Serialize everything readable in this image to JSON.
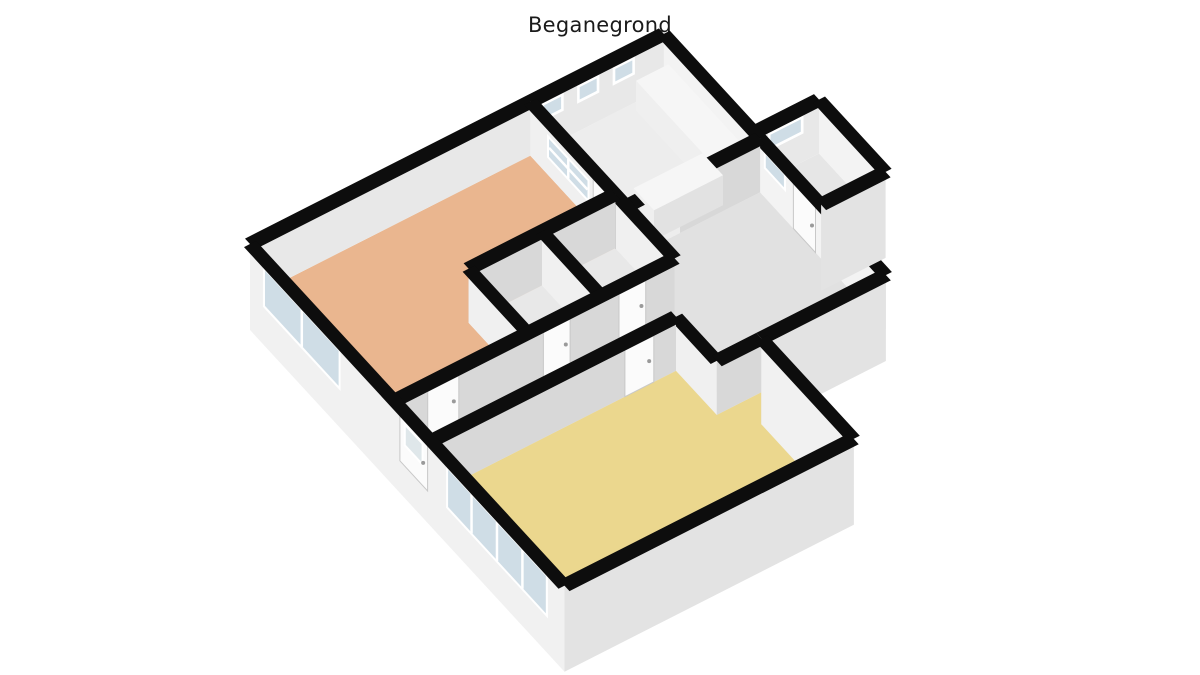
{
  "title": "Beganegrond",
  "colors": {
    "background": "#ffffff",
    "title_color": "#1a1a1a",
    "wall_top": "#0d0d0d",
    "face_a_far": "#e8e8e8",
    "face_a_int": "#d8d8d8",
    "face_a_near": "#e3e3e3",
    "face_b_far": "#f3f3f3",
    "face_b_int": "#f0f0f0",
    "face_b_near": "#f1f1f1",
    "frame": "#ffffff",
    "glass": "#cfdde6",
    "glass_frosted": "#dfe7ea",
    "door": "#fbfbfb",
    "door_edge": "#c8c8c8",
    "handle": "#9a9a9a",
    "counter_top": "#f6f6f6",
    "counter_face_a": "#e2e2e2",
    "counter_face_b": "#efefef",
    "cooktop": "#161616",
    "burner": "#c41414",
    "burner_center": "#8a0e0e",
    "radiator": "#fcfcfc",
    "floor_living": "#eab68f",
    "floor_bedroom": "#ebd78e",
    "floor_kitchen": "#ededed",
    "floor_hall": "#e1e1e1",
    "floor_small_room": "#e8e8e8",
    "floor_storage": "#e6e6e6"
  },
  "plan": {
    "origin": [
      250,
      298
    ],
    "axis_u": [
      44.5,
      -22.6
    ],
    "axis_v": [
      37.0,
      40.2
    ],
    "wall_height_px": 54,
    "plinth_px": 32,
    "wall_thickness_m": 0.27,
    "rooms": [
      {
        "name": "living-room",
        "color": "#eab68f",
        "poly": [
          [
            0,
            0
          ],
          [
            6.3,
            0
          ],
          [
            6.3,
            2.3
          ],
          [
            3.0,
            2.3
          ],
          [
            3.0,
            3.9
          ],
          [
            0,
            3.9
          ]
        ]
      },
      {
        "name": "kitchen",
        "color": "#ededed",
        "poly": [
          [
            6.3,
            0
          ],
          [
            9.3,
            0
          ],
          [
            9.3,
            2.6
          ],
          [
            6.3,
            2.6
          ]
        ]
      },
      {
        "name": "hallway",
        "color": "#e1e1e1",
        "poly": [
          [
            0,
            3.9
          ],
          [
            6.3,
            3.9
          ],
          [
            6.3,
            2.6
          ],
          [
            9.3,
            2.6
          ],
          [
            9.3,
            6.0
          ],
          [
            5.5,
            6.0
          ],
          [
            5.5,
            4.9
          ],
          [
            0,
            4.9
          ]
        ]
      },
      {
        "name": "toilet",
        "color": "#e8e8e8",
        "poly": [
          [
            3.0,
            2.3
          ],
          [
            4.65,
            2.3
          ],
          [
            4.65,
            3.9
          ],
          [
            3.0,
            3.9
          ]
        ]
      },
      {
        "name": "bathroom",
        "color": "#e8e8e8",
        "poly": [
          [
            4.65,
            2.3
          ],
          [
            6.3,
            2.3
          ],
          [
            6.3,
            3.9
          ],
          [
            4.65,
            3.9
          ]
        ]
      },
      {
        "name": "bedroom",
        "color": "#ebd78e",
        "poly": [
          [
            0,
            4.9
          ],
          [
            5.5,
            4.9
          ],
          [
            5.5,
            6.0
          ],
          [
            6.5,
            6.0
          ],
          [
            6.5,
            8.5
          ],
          [
            0,
            8.5
          ]
        ]
      },
      {
        "name": "storage",
        "color": "#e6e6e6",
        "poly": [
          [
            9.3,
            2.45
          ],
          [
            10.75,
            2.45
          ],
          [
            10.75,
            4.25
          ],
          [
            9.3,
            4.25
          ]
        ]
      }
    ],
    "walls": [
      {
        "name": "exterior-wall-nw",
        "p1": [
          0,
          0
        ],
        "p2": [
          9.3,
          0
        ],
        "kind": "far"
      },
      {
        "name": "exterior-wall-ne",
        "p1": [
          9.3,
          0
        ],
        "p2": [
          9.3,
          6.0
        ],
        "kind": "far"
      },
      {
        "name": "storage-wall-nw",
        "p1": [
          9.3,
          2.45
        ],
        "p2": [
          10.75,
          2.45
        ],
        "kind": "far"
      },
      {
        "name": "storage-wall-ne",
        "p1": [
          10.75,
          2.45
        ],
        "p2": [
          10.75,
          4.25
        ],
        "kind": "far"
      },
      {
        "name": "storage-wall-se",
        "p1": [
          9.3,
          4.25
        ],
        "p2": [
          10.75,
          4.25
        ],
        "kind": "near"
      },
      {
        "name": "wall-living-kitchen",
        "p1": [
          6.3,
          0
        ],
        "p2": [
          6.3,
          3.9
        ],
        "kind": "int"
      },
      {
        "name": "wall-kitchen-hall-a",
        "p1": [
          6.3,
          2.6
        ],
        "p2": [
          6.6,
          2.6
        ],
        "kind": "int"
      },
      {
        "name": "wall-kitchen-hall-b",
        "p1": [
          7.5,
          2.6
        ],
        "p2": [
          9.3,
          2.6
        ],
        "kind": "int"
      },
      {
        "name": "wall-smallrooms-nw",
        "p1": [
          3.0,
          2.3
        ],
        "p2": [
          6.3,
          2.3
        ],
        "kind": "int"
      },
      {
        "name": "wall-smallrooms-w",
        "p1": [
          3.0,
          2.3
        ],
        "p2": [
          3.0,
          3.9
        ],
        "kind": "int"
      },
      {
        "name": "wall-toilet-bathroom",
        "p1": [
          4.65,
          2.3
        ],
        "p2": [
          4.65,
          3.9
        ],
        "kind": "int"
      },
      {
        "name": "wall-corridor-nw",
        "p1": [
          0,
          3.9
        ],
        "p2": [
          6.3,
          3.9
        ],
        "kind": "int"
      },
      {
        "name": "wall-corridor-bedroom",
        "p1": [
          0,
          4.9
        ],
        "p2": [
          5.5,
          4.9
        ],
        "kind": "int"
      },
      {
        "name": "wall-closet-ne",
        "p1": [
          5.5,
          4.9
        ],
        "p2": [
          5.5,
          6.0
        ],
        "kind": "int"
      },
      {
        "name": "wall-closet-se",
        "p1": [
          5.5,
          6.0
        ],
        "p2": [
          6.5,
          6.0
        ],
        "kind": "int"
      },
      {
        "name": "wall-bedroom-ne",
        "p1": [
          6.5,
          6.0
        ],
        "p2": [
          6.5,
          8.5
        ],
        "kind": "near"
      },
      {
        "name": "exterior-wall-sw",
        "p1": [
          0,
          0
        ],
        "p2": [
          0,
          8.5
        ],
        "kind": "near"
      },
      {
        "name": "exterior-wall-se-bedroom",
        "p1": [
          0,
          8.5
        ],
        "p2": [
          6.5,
          8.5
        ],
        "kind": "near"
      },
      {
        "name": "exterior-wall-se-hall",
        "p1": [
          6.5,
          6.0
        ],
        "p2": [
          9.3,
          6.0
        ],
        "kind": "near"
      }
    ],
    "windows": [
      {
        "name": "kitchen-clerestory-1",
        "wall": "exterior-wall-nw",
        "from": 6.55,
        "to": 7.05,
        "y0": 0.52,
        "y1": 0.86
      },
      {
        "name": "kitchen-clerestory-2",
        "wall": "exterior-wall-nw",
        "from": 7.35,
        "to": 7.85,
        "y0": 0.52,
        "y1": 0.86
      },
      {
        "name": "kitchen-clerestory-3",
        "wall": "exterior-wall-nw",
        "from": 8.15,
        "to": 8.65,
        "y0": 0.52,
        "y1": 0.86
      },
      {
        "name": "hall-high-window",
        "wall": "exterior-wall-ne",
        "from": 2.7,
        "to": 3.3,
        "y0": 0.52,
        "y1": 0.86
      },
      {
        "name": "storage-high-window",
        "wall": "storage-wall-nw",
        "from": 0.3,
        "to": 1.1,
        "y0": 0.52,
        "y1": 0.86
      },
      {
        "name": "kitchen-hatch-window",
        "wall": "wall-living-kitchen",
        "from": 0.45,
        "to": 1.6,
        "y0": 0.3,
        "y1": 0.74,
        "mullions": 1,
        "hmullions": 1
      },
      {
        "name": "living-room-window",
        "wall": "exterior-wall-sw",
        "from": 0.35,
        "to": 2.45,
        "y0": 0.1,
        "y1": 0.86,
        "mullions": 1
      },
      {
        "name": "bedroom-sliding-window",
        "wall": "exterior-wall-sw",
        "from": 5.3,
        "to": 8.05,
        "y0": 0.06,
        "y1": 0.86,
        "mullions": 3
      }
    ],
    "doors": [
      {
        "name": "kitchen-door",
        "wall": "wall-living-kitchen",
        "from": 1.7,
        "to": 2.3
      },
      {
        "name": "living-room-door",
        "wall": "wall-corridor-nw",
        "from": 0.75,
        "to": 1.45
      },
      {
        "name": "toilet-door",
        "wall": "wall-corridor-nw",
        "from": 3.35,
        "to": 3.95
      },
      {
        "name": "bathroom-door",
        "wall": "wall-corridor-nw",
        "from": 5.05,
        "to": 5.65
      },
      {
        "name": "bedroom-door",
        "wall": "wall-corridor-bedroom",
        "from": 4.35,
        "to": 5.0
      },
      {
        "name": "storage-door",
        "wall": "exterior-wall-ne",
        "from": 3.5,
        "to": 4.1
      },
      {
        "name": "front-door",
        "wall": "exterior-wall-sw",
        "from": 4.05,
        "to": 4.8,
        "pane": true
      }
    ],
    "objects": {
      "counters": [
        {
          "name": "kitchen-counter-return",
          "rect": [
            7.0,
            1.95,
            8.55,
            2.5
          ],
          "h": 30
        },
        {
          "name": "kitchen-counter-main",
          "rect": [
            8.55,
            0.15,
            9.28,
            2.5
          ],
          "h": 30
        }
      ],
      "cooktop": {
        "name": "cooktop",
        "rect": [
          8.62,
          0.95,
          9.22,
          1.55
        ],
        "h": 31,
        "burners": [
          [
            8.77,
            1.1
          ],
          [
            9.07,
            1.1
          ],
          [
            8.77,
            1.4
          ],
          [
            9.07,
            1.4
          ]
        ]
      },
      "radiator": {
        "name": "radiator",
        "rect": [
          2.48,
          3.93,
          2.78,
          4.12
        ],
        "h": 14
      }
    }
  }
}
